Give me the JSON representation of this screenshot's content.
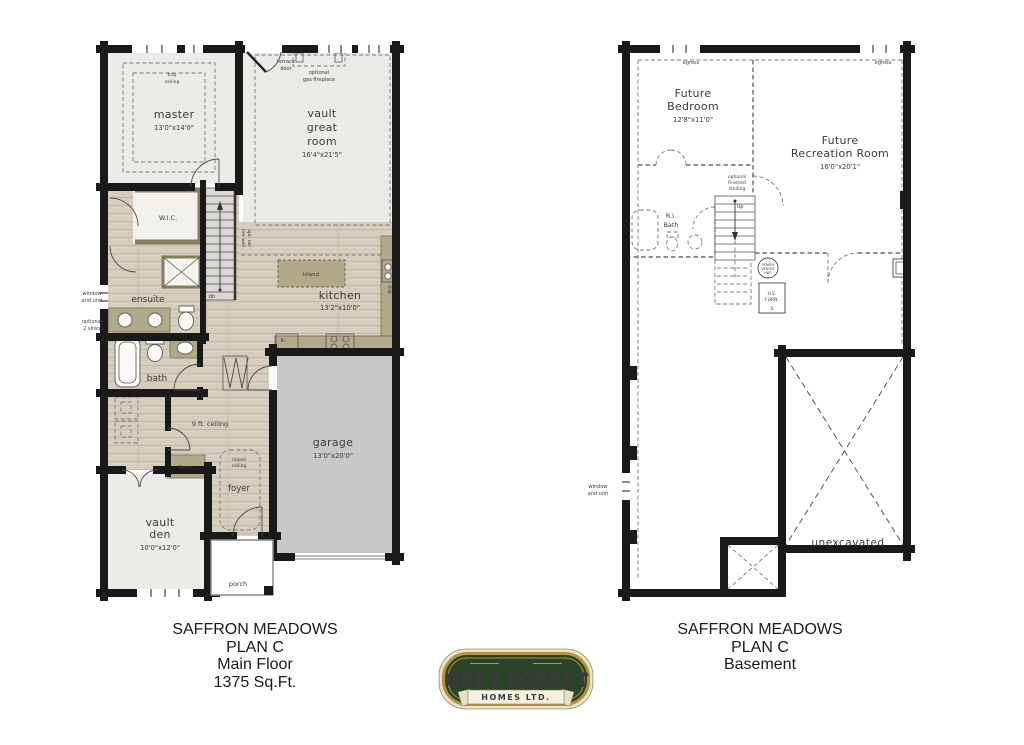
{
  "titles": {
    "main": [
      "SAFFRON MEADOWS",
      "PLAN C",
      "Main Floor",
      "1375 Sq.Ft."
    ],
    "basement": [
      "SAFFRON MEADOWS",
      "PLAN C",
      "Basement"
    ]
  },
  "logo": {
    "est": "Est 1990",
    "name": "GREY FOREST",
    "subtitle": "HOMES LTD."
  },
  "colors": {
    "wall": "#191919",
    "wood": "#d5cdbe",
    "carpet": "#ebebe8",
    "garage": "#c8c8c8",
    "casework": "#b2a98b",
    "logo_green": "#2a4227",
    "logo_gold": "#b3953f",
    "logo_cream": "#ece3cb"
  },
  "main_floor": {
    "master": {
      "label": "master",
      "dims": "13'0\"x14'0\""
    },
    "tray": {
      "l1": "tray",
      "l2": "ceiling"
    },
    "great_room": {
      "l1": "vault",
      "l2": "great",
      "l3": "room",
      "dims": "16'4\"x21'5\""
    },
    "terrace": {
      "l1": "terrace",
      "l2": "door"
    },
    "fireplace": {
      "l1": "optional",
      "l2": "gas fireplace"
    },
    "wic": {
      "label": "W.I.C."
    },
    "ensuite": {
      "label": "ensuite"
    },
    "window_unit": {
      "l1": "window",
      "l2": "and unit"
    },
    "opt_sinks": {
      "l1": "optional",
      "l2": "2 sinks"
    },
    "stairs": {
      "dn": "dn",
      "rail1": "low wall",
      "rail2": "opt. rail"
    },
    "kitchen": {
      "label": "kitchen",
      "dims": "13'2\"x10'0\"",
      "island": "island",
      "dw": "D.W.",
      "r": "R."
    },
    "bath": {
      "label": "bath"
    },
    "hall": {
      "ceiling": "9 ft. ceiling",
      "linen": "linen"
    },
    "foyer": {
      "label": "foyer",
      "raised1": "raised",
      "raised2": "ceiling"
    },
    "den": {
      "l1": "vault",
      "l2": "den",
      "dims": "10'0\"x12'0\""
    },
    "garage": {
      "label": "garage",
      "dims": "13'0\"x20'0\""
    },
    "porch": {
      "label": "porch"
    }
  },
  "basement": {
    "egress": "egress",
    "bedroom": {
      "l1": "Future",
      "l2": "Bedroom",
      "dims": "12'8\"x11'0\""
    },
    "rec_room": {
      "l1": "Future",
      "l2": "Recreation Room",
      "dims": "16'0\"x20'1\""
    },
    "landing": {
      "l1": "optional",
      "l2": "finished",
      "l3": "landing"
    },
    "stairs": {
      "up": "Up"
    },
    "ri_bath": {
      "l1": "R.I.",
      "l2": "Bath"
    },
    "hwt": {
      "l1": "POWER",
      "l2": "VENTED",
      "l3": "HWT"
    },
    "furnace": {
      "l1": "H.E.",
      "l2": "FURN.",
      "l3": "S"
    },
    "window_unit": {
      "l1": "window",
      "l2": "and unit"
    },
    "unexcavated": "unexcavated"
  }
}
